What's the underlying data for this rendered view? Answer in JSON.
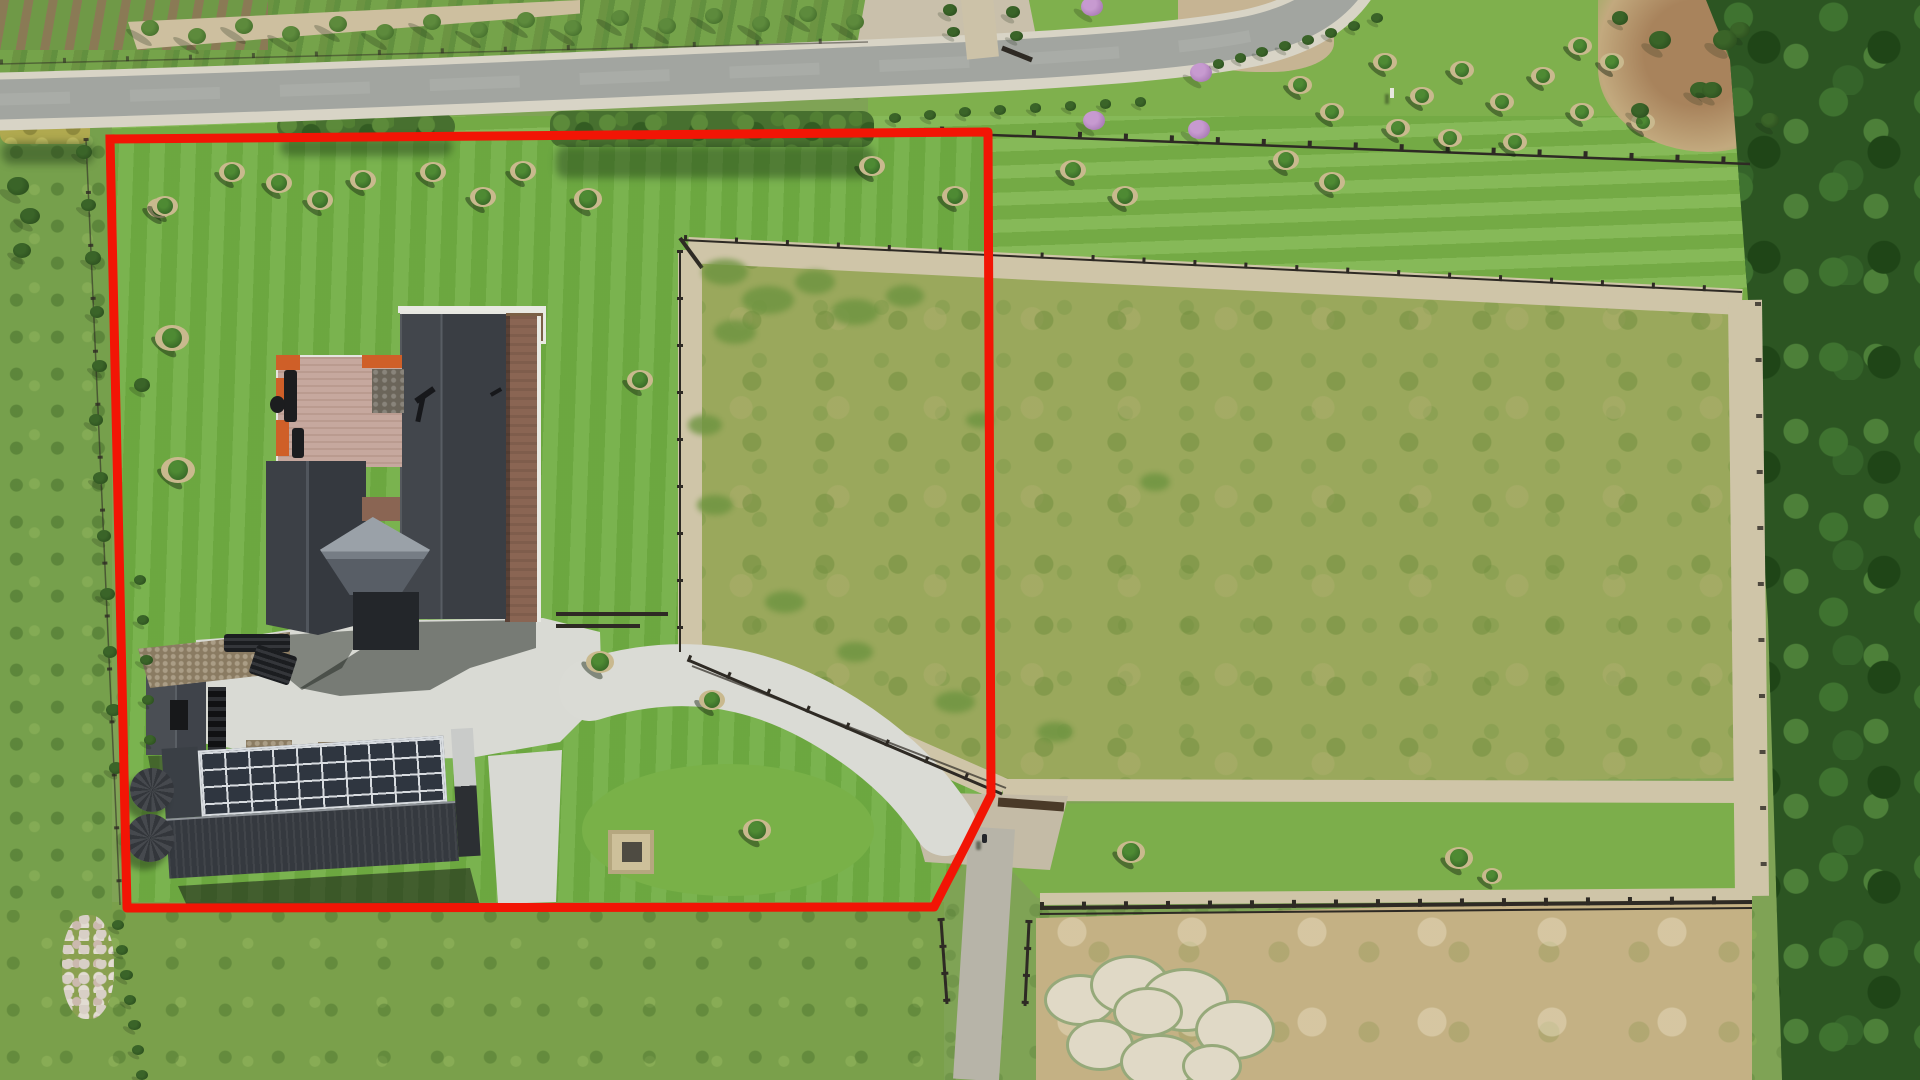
{
  "meta": {
    "title": "Aerial drone photograph of a rural lifestyle property with a red land-parcel boundary outline",
    "scene_type": "real-estate aerial photo",
    "visible_text": "none"
  },
  "palette": {
    "boundary_red": "#f21505",
    "lawn_green": "#72ae44",
    "paddock_olive": "#9aa85c",
    "dry_paddock_tan": "#c4b184",
    "road_asphalt": "#a2a5a0",
    "gravel": "#cfc5a8",
    "concrete": "#dadbd5",
    "roof_charcoal": "#3c4046",
    "solar_panel": "#2f3640",
    "deck_wood": "#c6a89e",
    "deck_accent_orange": "#cf5f28",
    "forest_green": "#2c5522"
  },
  "boundary": {
    "stroke_width": 9,
    "points": [
      [
        110,
        139
      ],
      [
        988,
        132
      ],
      [
        991,
        795
      ],
      [
        966,
        845
      ],
      [
        934,
        907
      ],
      [
        127,
        908
      ],
      [
        110,
        139
      ]
    ]
  },
  "scene": {
    "mulch_trees": [
      [
        232,
        172,
        1
      ],
      [
        279,
        183,
        1
      ],
      [
        320,
        200,
        1
      ],
      [
        363,
        180,
        1
      ],
      [
        433,
        172,
        1
      ],
      [
        483,
        197,
        1
      ],
      [
        523,
        171,
        1
      ],
      [
        588,
        199,
        1.1
      ],
      [
        160,
        208,
        1
      ],
      [
        165,
        206,
        1
      ],
      [
        172,
        338,
        1.3
      ],
      [
        178,
        470,
        1.3
      ],
      [
        640,
        380,
        1
      ],
      [
        600,
        662,
        1.1
      ],
      [
        712,
        700,
        1
      ],
      [
        757,
        830,
        1.1
      ],
      [
        872,
        166,
        1
      ],
      [
        955,
        196,
        1
      ],
      [
        1073,
        170,
        1
      ],
      [
        1125,
        196,
        1
      ],
      [
        1286,
        160,
        1
      ],
      [
        1332,
        182,
        1
      ],
      [
        1131,
        852,
        1.1
      ],
      [
        1459,
        858,
        1.1
      ],
      [
        1492,
        876,
        0.8
      ],
      [
        1385,
        62,
        0.9
      ],
      [
        1422,
        96,
        0.9
      ],
      [
        1462,
        70,
        0.9
      ],
      [
        1502,
        102,
        0.9
      ],
      [
        1543,
        76,
        0.9
      ],
      [
        1582,
        112,
        0.9
      ],
      [
        1612,
        62,
        0.9
      ],
      [
        1643,
        122,
        0.9
      ],
      [
        1398,
        128,
        0.9
      ],
      [
        1580,
        46,
        0.9
      ],
      [
        1515,
        142,
        0.9
      ],
      [
        1450,
        138,
        0.9
      ],
      [
        1300,
        85,
        0.9
      ],
      [
        1332,
        112,
        0.9
      ]
    ],
    "orchard_trees": [
      [
        150,
        28
      ],
      [
        197,
        36
      ],
      [
        244,
        26
      ],
      [
        291,
        34
      ],
      [
        338,
        24
      ],
      [
        385,
        32
      ],
      [
        432,
        22
      ],
      [
        479,
        30
      ],
      [
        526,
        20
      ],
      [
        573,
        28
      ],
      [
        620,
        18
      ],
      [
        667,
        26
      ],
      [
        714,
        16
      ],
      [
        761,
        24
      ],
      [
        808,
        14
      ],
      [
        855,
        22
      ]
    ],
    "purple_trees": [
      [
        1094,
        120
      ],
      [
        1199,
        129
      ],
      [
        1201,
        72
      ],
      [
        1092,
        6
      ]
    ],
    "shrubs": [
      [
        84,
        152,
        16
      ],
      [
        88,
        205,
        15
      ],
      [
        93,
        258,
        16
      ],
      [
        97,
        312,
        14
      ],
      [
        99,
        366,
        15
      ],
      [
        18,
        186,
        22
      ],
      [
        30,
        216,
        20
      ],
      [
        22,
        250,
        18
      ],
      [
        96,
        420,
        14
      ],
      [
        100,
        478,
        15
      ],
      [
        104,
        536,
        14
      ],
      [
        107,
        594,
        15
      ],
      [
        110,
        652,
        14
      ],
      [
        113,
        710,
        15
      ],
      [
        116,
        768,
        14
      ],
      [
        140,
        580,
        12
      ],
      [
        143,
        620,
        12
      ],
      [
        146,
        660,
        13
      ],
      [
        148,
        700,
        12
      ],
      [
        150,
        740,
        12
      ],
      [
        142,
        385,
        16
      ],
      [
        895,
        118,
        12
      ],
      [
        930,
        115,
        12
      ],
      [
        965,
        112,
        12
      ],
      [
        1000,
        110,
        12
      ],
      [
        1035,
        108,
        11
      ],
      [
        1070,
        106,
        11
      ],
      [
        1105,
        104,
        11
      ],
      [
        1140,
        102,
        11
      ],
      [
        1262,
        52,
        12
      ],
      [
        1285,
        46,
        12
      ],
      [
        1308,
        40,
        12
      ],
      [
        1331,
        33,
        12
      ],
      [
        1354,
        26,
        12
      ],
      [
        1377,
        18,
        12
      ],
      [
        1240,
        58,
        11
      ],
      [
        1218,
        64,
        11
      ],
      [
        950,
        10,
        14
      ],
      [
        953,
        32,
        13
      ],
      [
        1013,
        12,
        14
      ],
      [
        1016,
        36,
        13
      ],
      [
        1660,
        40,
        22
      ],
      [
        1700,
        90,
        20
      ],
      [
        1740,
        30,
        20
      ],
      [
        1770,
        120,
        18
      ],
      [
        1640,
        110,
        18
      ],
      [
        1620,
        18,
        16
      ],
      [
        118,
        925,
        12
      ],
      [
        122,
        950,
        12
      ],
      [
        126,
        975,
        13
      ],
      [
        130,
        1000,
        12
      ],
      [
        134,
        1025,
        13
      ],
      [
        138,
        1050,
        12
      ],
      [
        142,
        1075,
        12
      ],
      [
        1725,
        40,
        24
      ],
      [
        1712,
        90,
        20
      ]
    ],
    "weed_patches": [
      [
        725,
        272,
        46,
        26
      ],
      [
        768,
        300,
        52,
        28
      ],
      [
        815,
        282,
        40,
        24
      ],
      [
        855,
        312,
        48,
        26
      ],
      [
        905,
        296,
        38,
        22
      ],
      [
        735,
        332,
        42,
        24
      ],
      [
        705,
        425,
        34,
        20
      ],
      [
        715,
        505,
        36,
        20
      ],
      [
        785,
        602,
        40,
        22
      ],
      [
        855,
        652,
        36,
        20
      ],
      [
        955,
        702,
        40,
        22
      ],
      [
        1055,
        732,
        36,
        20
      ],
      [
        1155,
        482,
        30,
        18
      ],
      [
        980,
        420,
        28,
        16
      ]
    ],
    "white_mounds": [
      [
        1080,
        1000,
        72,
        52
      ],
      [
        1130,
        985,
        80,
        60
      ],
      [
        1185,
        1000,
        88,
        64
      ],
      [
        1235,
        1030,
        80,
        60
      ],
      [
        1100,
        1045,
        68,
        52
      ],
      [
        1160,
        1062,
        80,
        56
      ],
      [
        1212,
        1066,
        60,
        44
      ],
      [
        1148,
        1012,
        70,
        50
      ]
    ]
  }
}
